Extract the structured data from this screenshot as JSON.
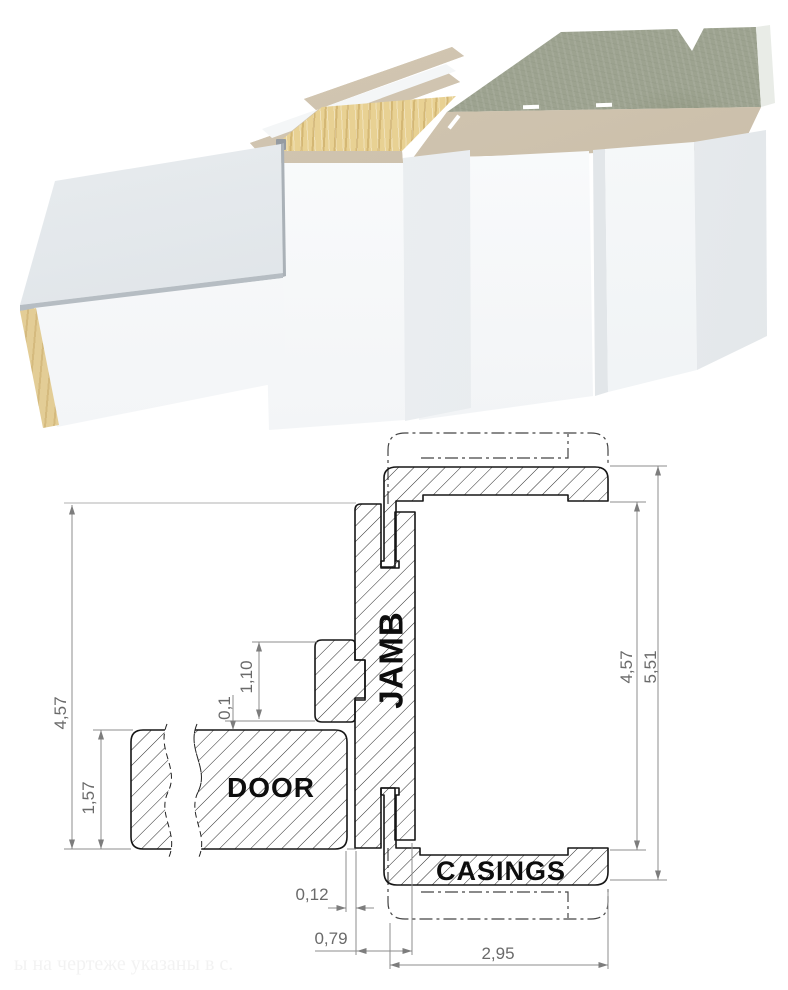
{
  "palette": {
    "outline_black": "#1a1a1a",
    "dimension_gray": "#8c8c8c",
    "dimension_text_gray": "#6a6a6a",
    "label_black": "#0d0d0d",
    "wood_cut": "#e8d193",
    "laminate_beige": "#ccc0ac",
    "wall_concrete_green": "#9da390",
    "panel_white": "#f9fafb",
    "panel_top_gray": "#e2e7ea"
  },
  "drawing": {
    "labels": {
      "door": "DOOR",
      "jamb": "JAMB",
      "casings": "CASINGS"
    },
    "dimensions": {
      "frame_depth_left": "4,57",
      "door_thickness": "1,57",
      "stop_height": "1,10",
      "stop_to_door_gap": "0,1",
      "door_to_jamb_gap": "0,12",
      "jamb_width": "0,79",
      "casing_width": "2,95",
      "frame_depth_right": "4,57",
      "overall_width": "5,51"
    },
    "watermark": "ы на чертеже указаны в с."
  }
}
